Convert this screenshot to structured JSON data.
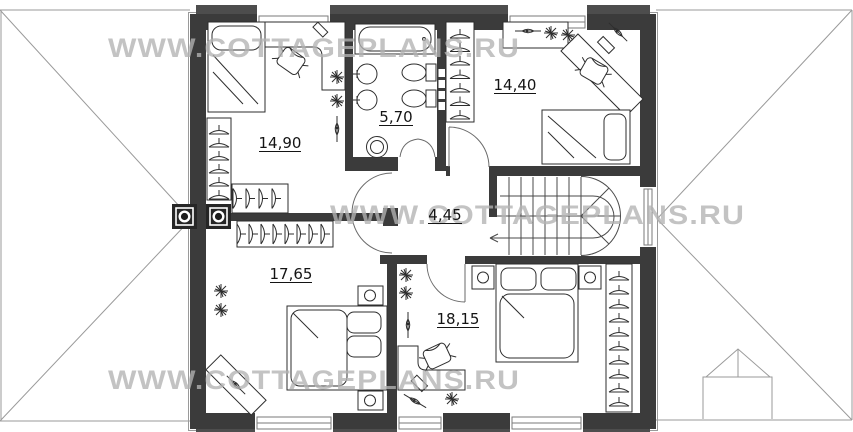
{
  "watermark": {
    "text": "WWW.COTTAGEPLANS.RU"
  },
  "rooms": [
    {
      "name": "bedroom-top-left",
      "area": "14,90"
    },
    {
      "name": "bathroom",
      "area": "5,70"
    },
    {
      "name": "bedroom-top-right",
      "area": "14,40"
    },
    {
      "name": "hallway",
      "area": "4,45"
    },
    {
      "name": "bedroom-bottom-left",
      "area": "17,65"
    },
    {
      "name": "bedroom-bottom-right",
      "area": "18,15"
    }
  ],
  "colors": {
    "wall": "#3b3b3b",
    "eave_band": "#4d4d4d",
    "line": "#2e2e2e",
    "roof_line": "#9a9a9a",
    "watermark": "#b3b3b3",
    "background": "#ffffff"
  }
}
